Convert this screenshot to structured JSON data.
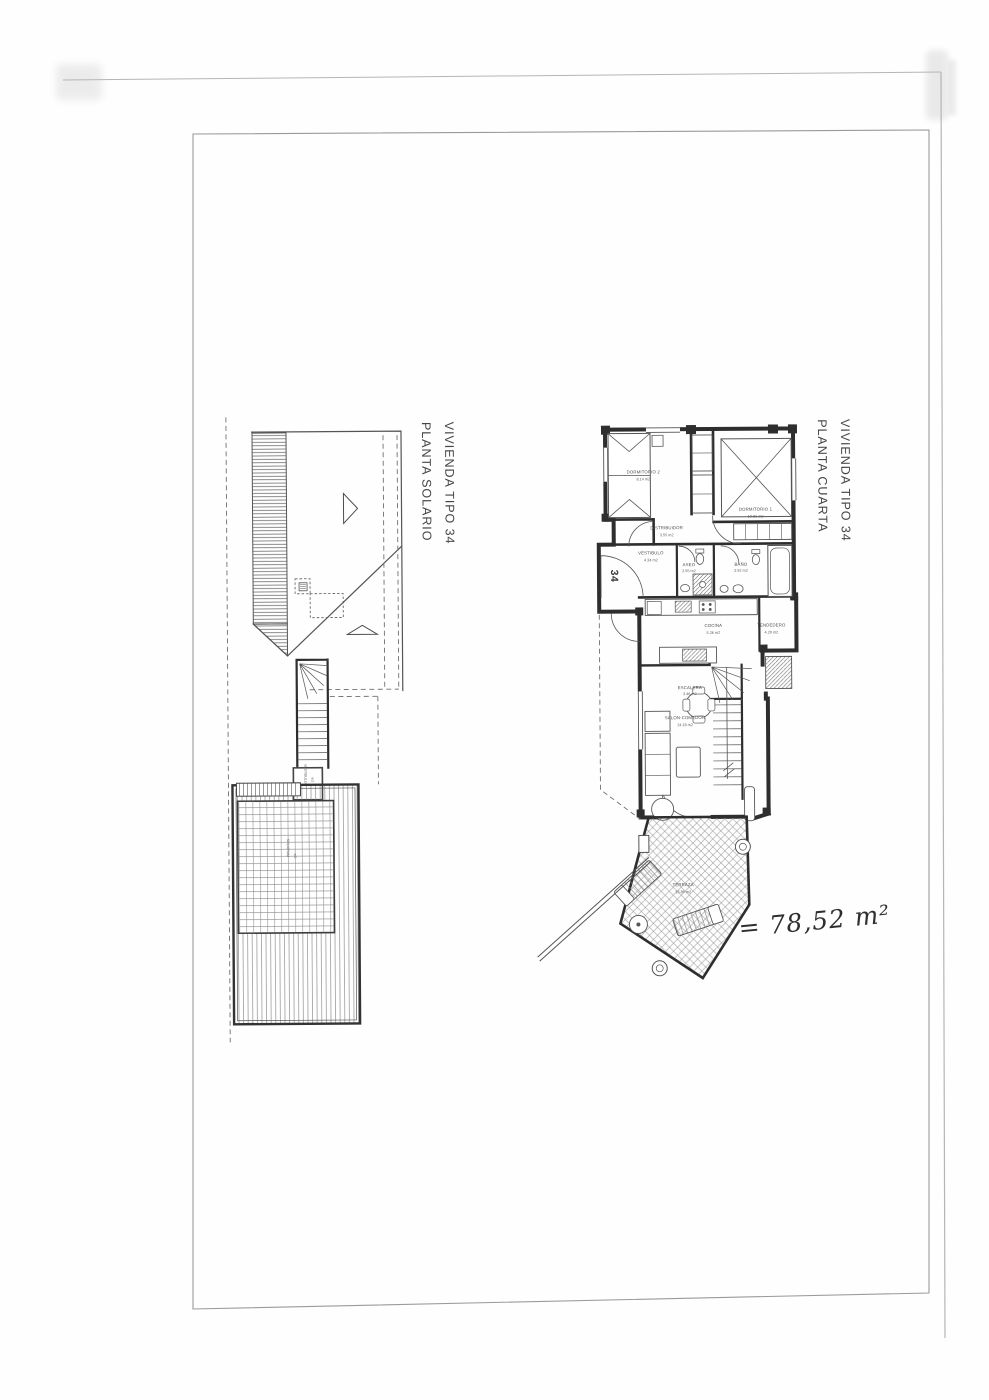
{
  "page": {
    "annotation_handwritten": "= 78,52 m²"
  },
  "plan_cuarta": {
    "title_line1": "PLANTA CUARTA",
    "title_line2": "VIVIENDA TIPO 34",
    "unit_number": "34",
    "rooms": [
      {
        "name": "DORMITORIO 2",
        "area": "8.14 m2"
      },
      {
        "name": "DORMITORIO 1",
        "area": "10.81 m2"
      },
      {
        "name": "DISTRIBUIDOR",
        "area": "3.55 m2"
      },
      {
        "name": "VESTIBULO",
        "area": "4.34 m2"
      },
      {
        "name": "ASEO",
        "area": "2.55 m2"
      },
      {
        "name": "BAÑO",
        "area": "3.92 m2"
      },
      {
        "name": "COCINA",
        "area": "5.26 m2"
      },
      {
        "name": "TENDEDERO",
        "area": "4.29 m2"
      },
      {
        "name": "ESCALERA",
        "area": "3.46 m2"
      },
      {
        "name": "SALON-COMEDOR",
        "area": "14.18 m2"
      },
      {
        "name": "TERRAZA",
        "area": "13.85 m2"
      }
    ]
  },
  "plan_solario": {
    "title_line1": "PLANTA SOLARIO",
    "title_line2": "VIVIENDA TIPO 34",
    "labels": {
      "solarium": {
        "name": "SOLARIUM",
        "area": "m2"
      },
      "stair_landing": {
        "name": "VESTIBULO",
        "area": "m2"
      }
    }
  }
}
